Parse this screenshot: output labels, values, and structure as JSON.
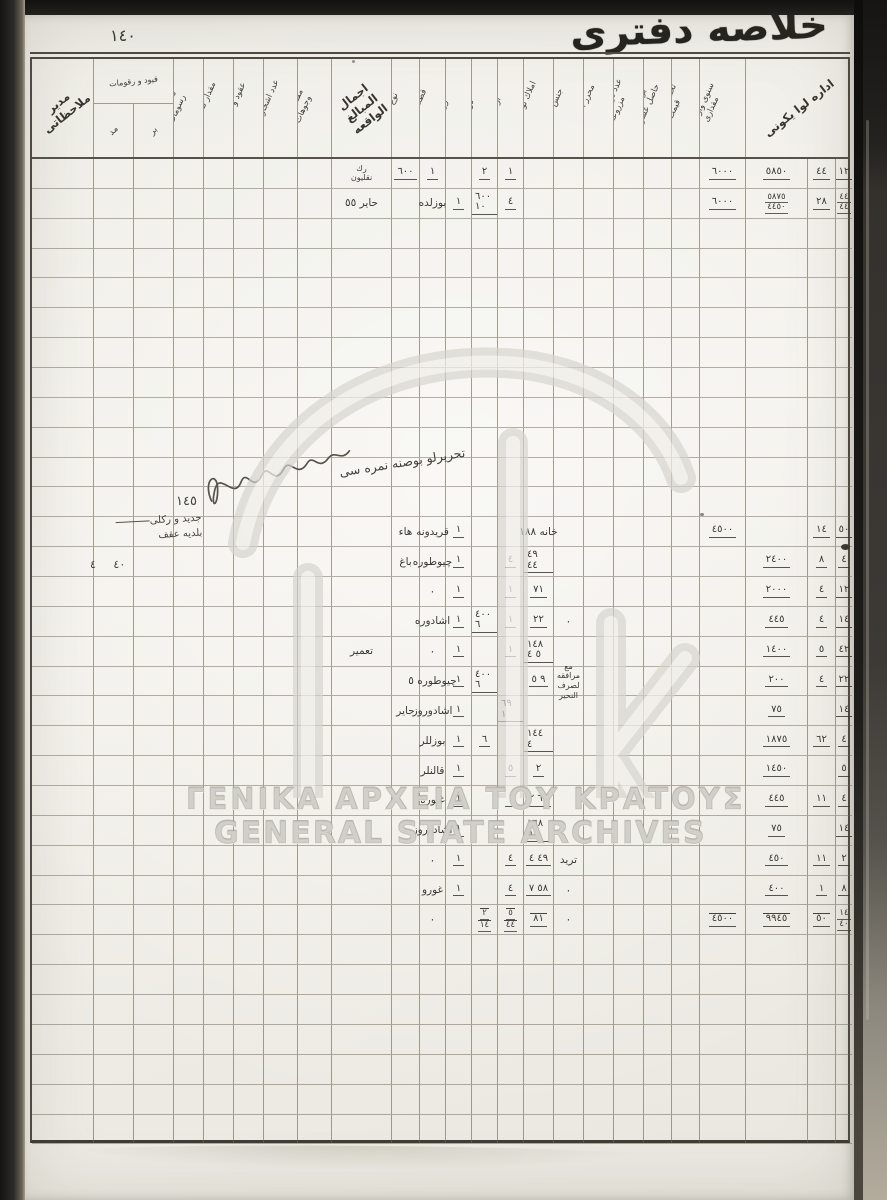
{
  "page": {
    "title_calligraphy": "خلاصه دفترى",
    "page_number": "١٤٠"
  },
  "watermark": {
    "line1": "ΓΕΝΙΚΑ ΑΡΧΕΙΑ ΤΟΥ ΚΡΑΤΟΥΣ",
    "line2": "GENERAL STATE ARCHIVES",
    "logo": "gak-monogram"
  },
  "annotations": {
    "diagonal_note": "تحريرلو بوصنه نمره سى",
    "entry_number": "١٤٥",
    "margin_note_line1": "جديد و ركلى",
    "margin_note_line2": "بلديه عقف",
    "margin_values": "٤٠ ٤"
  },
  "table": {
    "row_count": 33,
    "headers": [
      {
        "c": 0,
        "span": 1,
        "kind": "diag",
        "label": "مدير ملاحظاتى"
      },
      {
        "c": 1,
        "span": 2,
        "kind": "group",
        "label": "قيود و رقومات",
        "subs": [
          "مد",
          "بر"
        ]
      },
      {
        "c": 3,
        "kind": "vert",
        "label": "تكاليف و رسومات"
      },
      {
        "c": 4,
        "kind": "vert",
        "label": "مقدار تقسيمات"
      },
      {
        "c": 5,
        "kind": "vert",
        "label": "عقود و انتقالات"
      },
      {
        "c": 6,
        "kind": "vert",
        "label": "عدد اشجار زيتون"
      },
      {
        "c": 7,
        "kind": "vert",
        "label": "مقتنيات و وجوهات"
      },
      {
        "c": 8,
        "kind": "diag",
        "label": "اجمال المبالغ الواقعه"
      },
      {
        "c": 9,
        "kind": "vert",
        "label": "نوع محل"
      },
      {
        "c": 10,
        "kind": "vert",
        "label": "قطعه نمره"
      },
      {
        "c": 11,
        "kind": "vert",
        "label": "زراع"
      },
      {
        "c": 12,
        "kind": "vert",
        "label": "دونم"
      },
      {
        "c": 13,
        "kind": "vert",
        "label": "ارالجه"
      },
      {
        "c": 14,
        "kind": "vert",
        "label": "املاك نوعجيسى"
      },
      {
        "c": 15,
        "kind": "vert",
        "label": "جنس املاك"
      },
      {
        "c": 16,
        "kind": "vert",
        "label": "محرر اعمالات"
      },
      {
        "c": 17,
        "kind": "vert",
        "label": "عدد دونم اراضى مزروعه"
      },
      {
        "c": 18,
        "kind": "vert",
        "label": "بر سنه ده حاصل عشريات"
      },
      {
        "c": 19,
        "kind": "vert",
        "label": "تخمين اولنان قيمت"
      },
      {
        "c": 20,
        "kind": "vert",
        "label": "سنوى واردات مقدارى"
      },
      {
        "c": 21,
        "span": 3,
        "kind": "diag",
        "label": "اداره لوا يكونى"
      }
    ],
    "rows": [
      {
        "r": 0,
        "cells": [
          {
            "c": 8,
            "t": "رك\nنقليون",
            "k": "note"
          },
          {
            "c": 9,
            "t": "٦٠٠",
            "k": "n"
          },
          {
            "c": 10,
            "t": "١",
            "k": "n"
          },
          {
            "c": 12,
            "t": "٢",
            "k": "n"
          },
          {
            "c": 13,
            "t": "١",
            "k": "n"
          },
          {
            "c": 20,
            "t": "٦٠٠٠",
            "k": "n"
          },
          {
            "c": 21,
            "t": "٥٨٥٠",
            "k": "n"
          },
          {
            "c": 22,
            "t": "٤٤",
            "k": "n"
          },
          {
            "c": 23,
            "t": "١٢",
            "k": "n"
          }
        ]
      },
      {
        "r": 1,
        "cells": [
          {
            "c": 8,
            "t": "حاير ٥٥",
            "k": "name"
          },
          {
            "c": 10,
            "t": "بوزلده",
            "k": "name"
          },
          {
            "c": 11,
            "t": "١",
            "k": "n"
          },
          {
            "c": 12,
            "t": "٦٠٠ ١٠",
            "k": "n"
          },
          {
            "c": 13,
            "t": "٤",
            "k": "n"
          },
          {
            "c": 20,
            "t": "٦٠٠٠",
            "k": "n"
          },
          {
            "c": 21,
            "t": "٥٨٧٥\n٤٤٥٠",
            "k": "n2"
          },
          {
            "c": 22,
            "t": "٢٨",
            "k": "n"
          },
          {
            "c": 23,
            "t": "٤٤\n٤٤",
            "k": "n2"
          }
        ]
      },
      {
        "r": 12,
        "cells": [
          {
            "c": 9,
            "t": "هاء",
            "k": "name"
          },
          {
            "c": 10,
            "t": "قريدونه",
            "k": "name"
          },
          {
            "c": 11,
            "t": "١",
            "k": "n"
          },
          {
            "c": 14,
            "t": "خانه ١٨٨",
            "k": "name"
          },
          {
            "c": 20,
            "t": "٤٥٠٠",
            "k": "n"
          },
          {
            "c": 22,
            "t": "١٤",
            "k": "n"
          },
          {
            "c": 23,
            "t": "٥٠",
            "k": "n"
          }
        ]
      },
      {
        "r": 13,
        "cells": [
          {
            "c": 9,
            "t": "باغ",
            "k": "name"
          },
          {
            "c": 10,
            "t": "چيوطوره",
            "k": "name"
          },
          {
            "c": 11,
            "t": "١",
            "k": "n"
          },
          {
            "c": 13,
            "t": "٤",
            "k": "n"
          },
          {
            "c": 14,
            "t": "٤٩ ٤٤",
            "k": "n"
          },
          {
            "c": 21,
            "t": "٢٤٠٠",
            "k": "n"
          },
          {
            "c": 22,
            "t": "٨",
            "k": "n"
          },
          {
            "c": 23,
            "t": "٤",
            "k": "n"
          }
        ]
      },
      {
        "r": 14,
        "cells": [
          {
            "c": 10,
            "t": "٠",
            "k": "dot"
          },
          {
            "c": 11,
            "t": "١",
            "k": "n"
          },
          {
            "c": 13,
            "t": "١",
            "k": "n"
          },
          {
            "c": 14,
            "t": "٧١",
            "k": "n"
          },
          {
            "c": 21,
            "t": "٢٠٠٠",
            "k": "n"
          },
          {
            "c": 22,
            "t": "٤",
            "k": "n"
          },
          {
            "c": 23,
            "t": "١٢",
            "k": "n"
          }
        ]
      },
      {
        "r": 15,
        "cells": [
          {
            "c": 10,
            "t": "اشادوره",
            "k": "name"
          },
          {
            "c": 11,
            "t": "١",
            "k": "n"
          },
          {
            "c": 12,
            "t": "٤٠٠ ٦",
            "k": "n"
          },
          {
            "c": 13,
            "t": "١",
            "k": "n"
          },
          {
            "c": 14,
            "t": "٢٢",
            "k": "n"
          },
          {
            "c": 15,
            "t": "٠",
            "k": "dot"
          },
          {
            "c": 21,
            "t": "٤٤٥",
            "k": "n"
          },
          {
            "c": 22,
            "t": "٤",
            "k": "n"
          },
          {
            "c": 23,
            "t": "١٤",
            "k": "n"
          }
        ]
      },
      {
        "r": 16,
        "cells": [
          {
            "c": 8,
            "t": "تعمير",
            "k": "name"
          },
          {
            "c": 10,
            "t": "٠",
            "k": "dot"
          },
          {
            "c": 11,
            "t": "١",
            "k": "n"
          },
          {
            "c": 13,
            "t": "١",
            "k": "n"
          },
          {
            "c": 14,
            "t": "١٤٨ ٥ ٤",
            "k": "n"
          },
          {
            "c": 21,
            "t": "١٤٠٠",
            "k": "n"
          },
          {
            "c": 22,
            "t": "٥",
            "k": "n"
          },
          {
            "c": 23,
            "t": "٤٢",
            "k": "n"
          }
        ]
      },
      {
        "r": 17,
        "cells": [
          {
            "c": 10,
            "t": "چيوطوره ٥",
            "k": "name"
          },
          {
            "c": 11,
            "t": "١",
            "k": "n"
          },
          {
            "c": 12,
            "t": "٤٠٠ ٦",
            "k": "n"
          },
          {
            "c": 14,
            "t": "٩ ٥",
            "k": "n"
          },
          {
            "c": 15,
            "t": "مع مرافقه\nلصرف النحير",
            "k": "note"
          },
          {
            "c": 21,
            "t": "٢٠٠",
            "k": "n"
          },
          {
            "c": 22,
            "t": "٤",
            "k": "n"
          },
          {
            "c": 23,
            "t": "٢٢",
            "k": "n"
          }
        ]
      },
      {
        "r": 18,
        "cells": [
          {
            "c": 9,
            "t": "حاير",
            "k": "name"
          },
          {
            "c": 10,
            "t": "اشادوروز",
            "k": "name"
          },
          {
            "c": 11,
            "t": "١",
            "k": "n"
          },
          {
            "c": 13,
            "t": "٦٩ ١",
            "k": "n"
          },
          {
            "c": 21,
            "t": "٧٥",
            "k": "n"
          },
          {
            "c": 23,
            "t": "١٤",
            "k": "n"
          }
        ]
      },
      {
        "r": 19,
        "cells": [
          {
            "c": 10,
            "t": "بوزللر",
            "k": "name"
          },
          {
            "c": 11,
            "t": "١",
            "k": "n"
          },
          {
            "c": 12,
            "t": "٦",
            "k": "n"
          },
          {
            "c": 14,
            "t": "١٤٤ ٤",
            "k": "n"
          },
          {
            "c": 21,
            "t": "١٨٧٥",
            "k": "n"
          },
          {
            "c": 22,
            "t": "٦٢",
            "k": "n"
          },
          {
            "c": 23,
            "t": "٤",
            "k": "n"
          }
        ]
      },
      {
        "r": 20,
        "cells": [
          {
            "c": 10,
            "t": "قالنلر",
            "k": "name"
          },
          {
            "c": 11,
            "t": "١",
            "k": "n"
          },
          {
            "c": 13,
            "t": "٥",
            "k": "n"
          },
          {
            "c": 14,
            "t": "٢",
            "k": "n"
          },
          {
            "c": 21,
            "t": "١٤٥٠",
            "k": "n"
          },
          {
            "c": 23,
            "t": "٥",
            "k": "n"
          }
        ]
      },
      {
        "r": 21,
        "cells": [
          {
            "c": 10,
            "t": "غيوره",
            "k": "name"
          },
          {
            "c": 11,
            "t": "١",
            "k": "n"
          },
          {
            "c": 13,
            "t": "١",
            "k": "n"
          },
          {
            "c": 14,
            "t": "٦٠ ٢",
            "k": "n"
          },
          {
            "c": 21,
            "t": "٤٤٥",
            "k": "n"
          },
          {
            "c": 22,
            "t": "١١",
            "k": "n"
          },
          {
            "c": 23,
            "t": "٤",
            "k": "n"
          }
        ]
      },
      {
        "r": 22,
        "cells": [
          {
            "c": 10,
            "t": "اشادوروز",
            "k": "name"
          },
          {
            "c": 11,
            "t": "١",
            "k": "n"
          },
          {
            "c": 14,
            "t": "١٦٨ ٥",
            "k": "n"
          },
          {
            "c": 21,
            "t": "٧٥",
            "k": "n"
          },
          {
            "c": 23,
            "t": "١٤",
            "k": "n"
          }
        ]
      },
      {
        "r": 23,
        "cells": [
          {
            "c": 10,
            "t": "٠",
            "k": "dot"
          },
          {
            "c": 11,
            "t": "١",
            "k": "n"
          },
          {
            "c": 13,
            "t": "٤",
            "k": "n"
          },
          {
            "c": 14,
            "t": "٤٩ ٤",
            "k": "n"
          },
          {
            "c": 15,
            "t": "تريد",
            "k": "name"
          },
          {
            "c": 21,
            "t": "٤٥٠",
            "k": "n"
          },
          {
            "c": 22,
            "t": "١١",
            "k": "n"
          },
          {
            "c": 23,
            "t": "٢",
            "k": "n"
          }
        ]
      },
      {
        "r": 24,
        "cells": [
          {
            "c": 10,
            "t": "غورو",
            "k": "name"
          },
          {
            "c": 11,
            "t": "١",
            "k": "n"
          },
          {
            "c": 13,
            "t": "٤",
            "k": "n"
          },
          {
            "c": 14,
            "t": "٥٨ ٧",
            "k": "n"
          },
          {
            "c": 15,
            "t": "٠",
            "k": "dot"
          },
          {
            "c": 21,
            "t": "٤٠٠",
            "k": "n"
          },
          {
            "c": 22,
            "t": "١",
            "k": "n"
          },
          {
            "c": 23,
            "t": "٨",
            "k": "n"
          }
        ]
      },
      {
        "r": 25,
        "cells": [
          {
            "c": 10,
            "t": "٠",
            "k": "dot"
          },
          {
            "c": 12,
            "t": "٢\n١٤",
            "k": "n2",
            "s": 1
          },
          {
            "c": 13,
            "t": "٥\n٤٤",
            "k": "n2",
            "s": 1
          },
          {
            "c": 14,
            "t": "٨١",
            "k": "n",
            "s": 1
          },
          {
            "c": 15,
            "t": "٠",
            "k": "dot"
          },
          {
            "c": 20,
            "t": "٤٥٠٠",
            "k": "n",
            "s": 1
          },
          {
            "c": 21,
            "t": "٩٩٤٥",
            "k": "n",
            "s": 1
          },
          {
            "c": 22,
            "t": "٥٠",
            "k": "n",
            "s": 1
          },
          {
            "c": 23,
            "t": "١٤\n٤٠",
            "k": "n2"
          }
        ]
      }
    ]
  }
}
